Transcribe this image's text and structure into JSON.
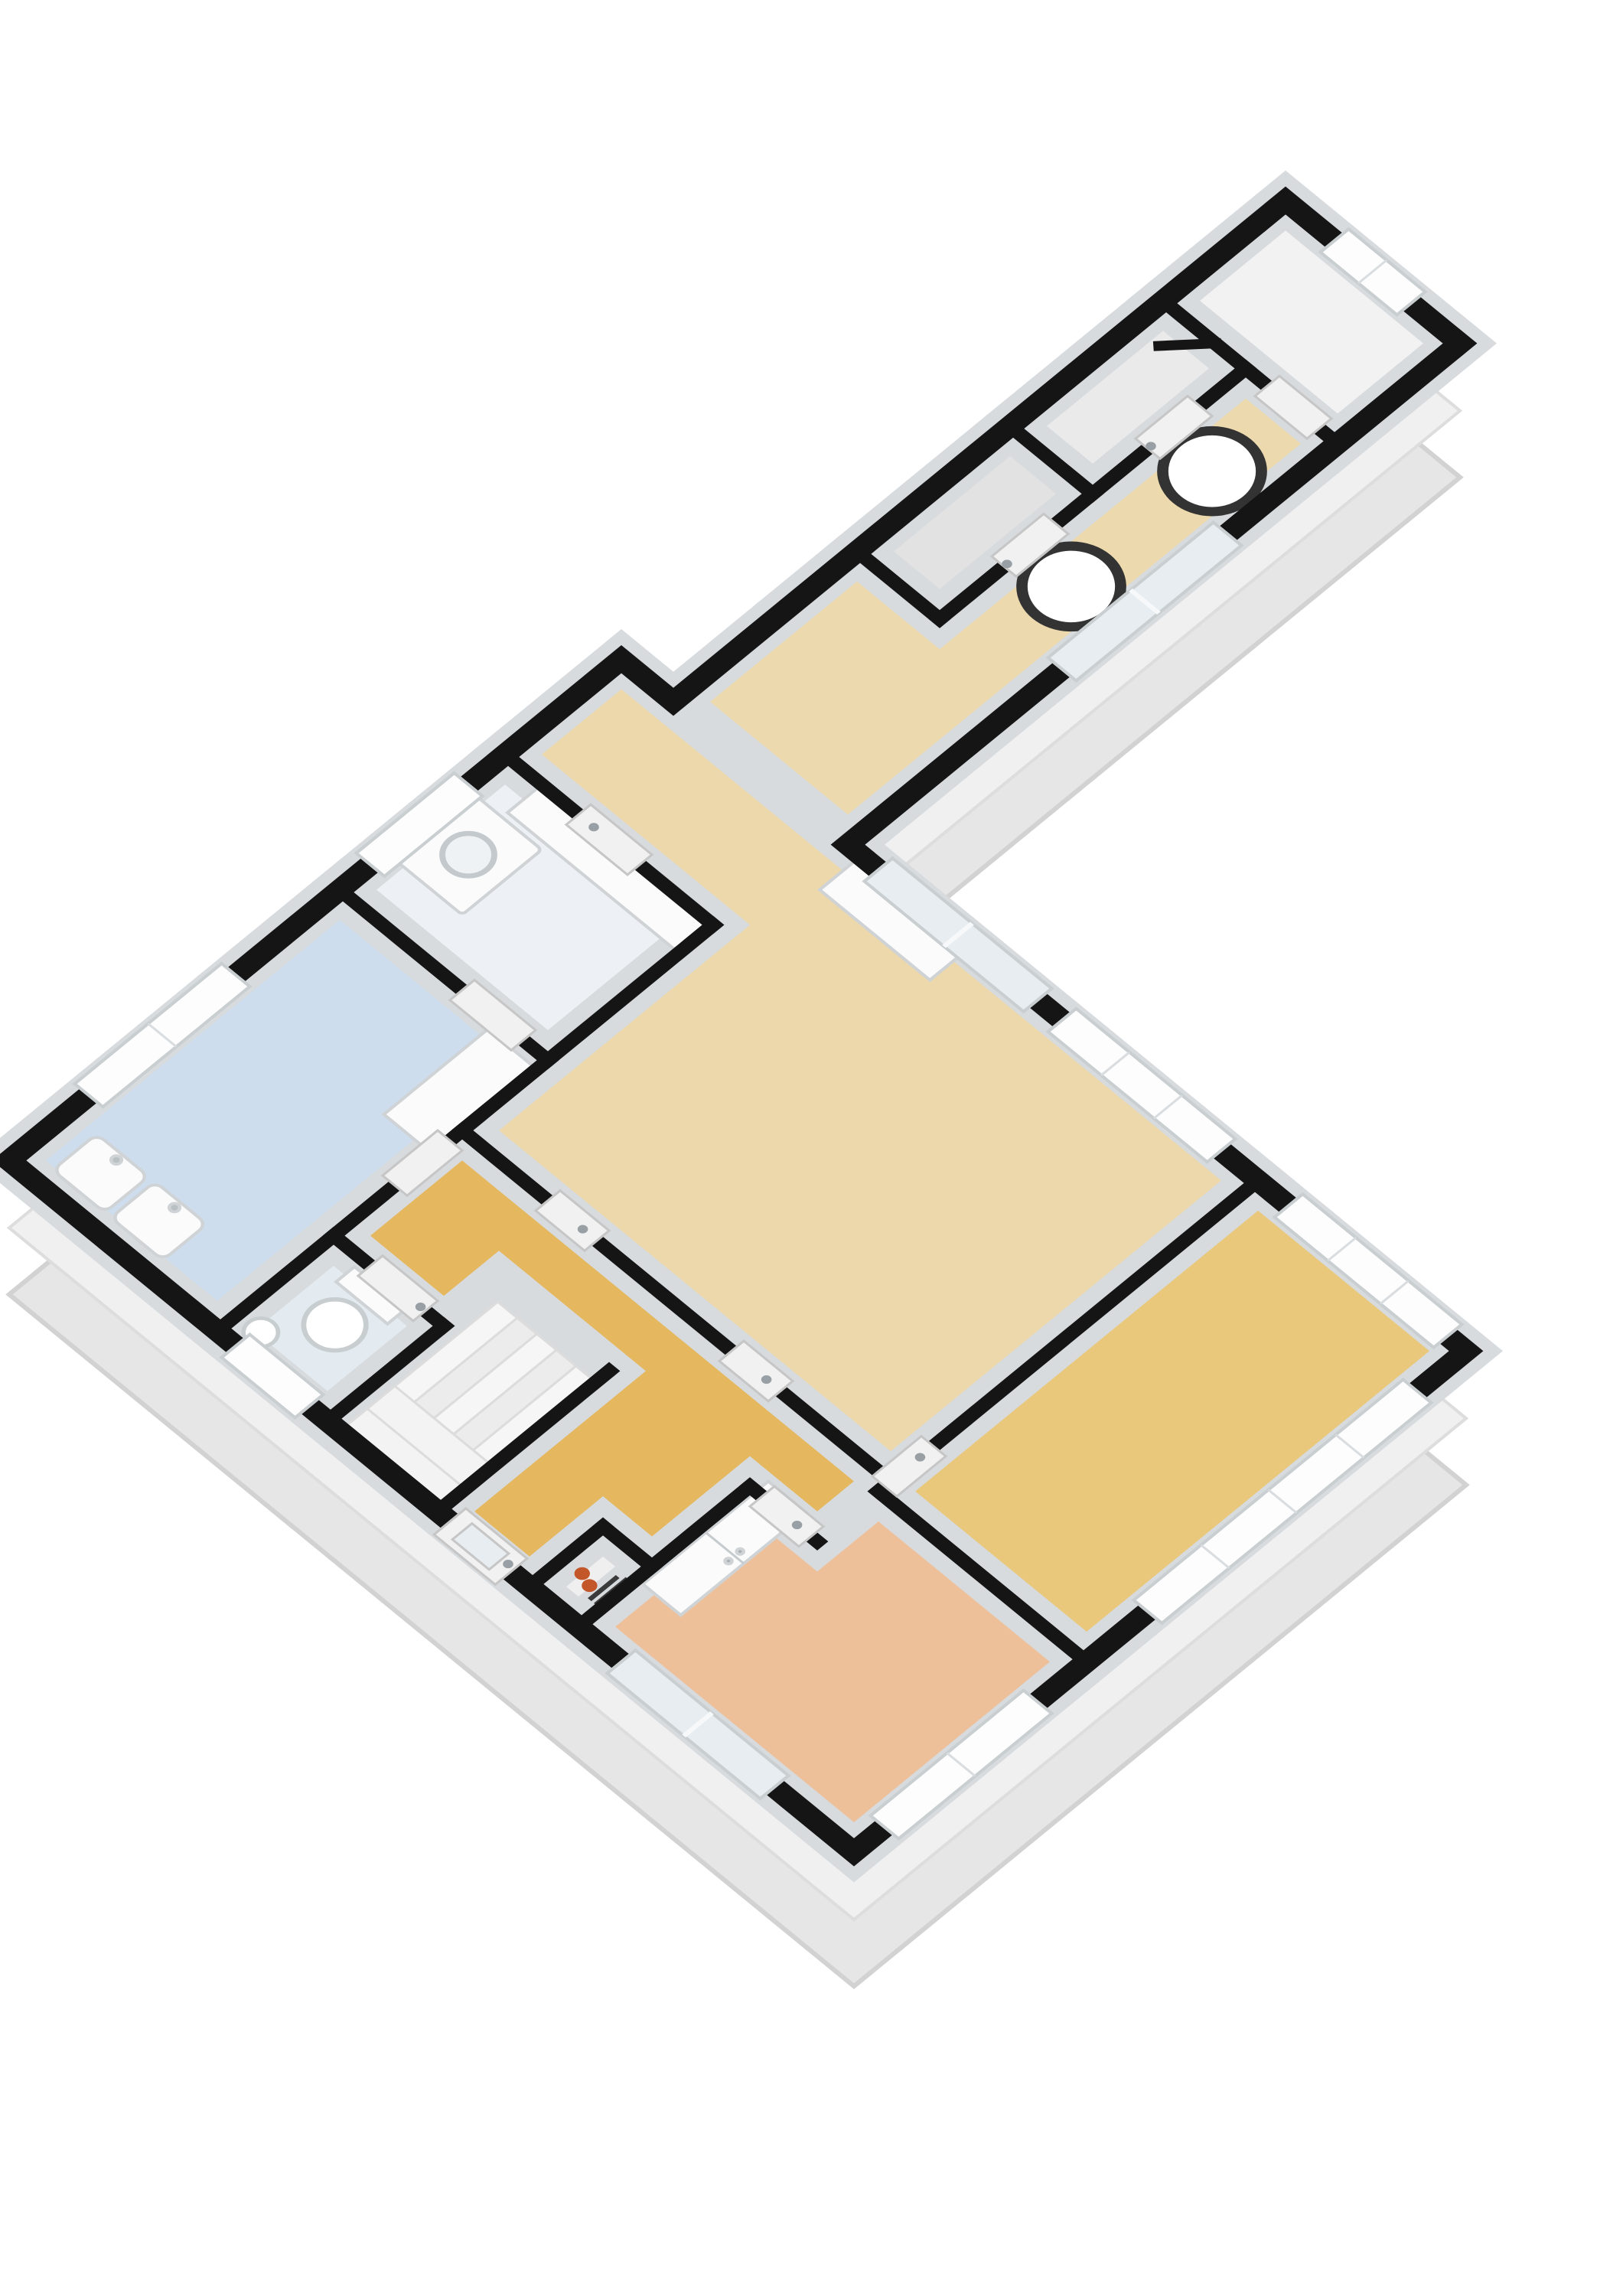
{
  "image_type": "3d-floor-plan-render",
  "view": "isometric-top-down",
  "background": "#ffffff",
  "palette": {
    "wall_cap": "#151515",
    "wall_inner": "#d7dbde",
    "extrude_far": "#e6e6e6",
    "extrude_near": "#f0f0f0",
    "window_glass": "#fdfdfd",
    "slider_glass": "#e7edf1",
    "window_frame": "#c9ced1",
    "mullion": "#d9dde0",
    "door_panel": "#f1f1f1",
    "door_frame": "#c6c6c6",
    "fixture_fill": "#fbfbfb",
    "fixture_stroke": "#cfd3d6",
    "handle_gray": "#98a0a5",
    "pipe_orange": "#c3572a",
    "rod_dark": "#3a3a3a",
    "ring_dark": "#333333",
    "stair_light": "#f6f6f6",
    "stair_mid": "#ececec",
    "stair_edge": "#dcdcdc"
  },
  "rooms": {
    "top_room": {
      "label": "top room",
      "color": "#f2f2f2"
    },
    "storage_1": {
      "label": "storage 1",
      "color": "#eaeaea"
    },
    "storage_2": {
      "label": "storage 2",
      "color": "#e2e2e2"
    },
    "wing_corridor": {
      "label": "corridor",
      "color": "#ecd9ae"
    },
    "living_room": {
      "label": "living room",
      "color": "#ecd8ab"
    },
    "utility_room": {
      "label": "utility room",
      "color": "#edf1f5"
    },
    "bathroom": {
      "label": "bathroom",
      "color": "#cedded"
    },
    "toilet_room": {
      "label": "toilet",
      "color": "#e3ebf1"
    },
    "stair_hall": {
      "label": "stair hall",
      "color": "#f1f3f4"
    },
    "hallway": {
      "label": "hallway",
      "color": "#e5b75e"
    },
    "bedroom_east": {
      "label": "bedroom east",
      "color": "#e9c87c"
    },
    "bedroom_south": {
      "label": "bedroom south",
      "color": "#eec09a"
    },
    "meter_niche": {
      "label": "meter cupboard",
      "color": "#efefef"
    }
  },
  "fixtures": [
    "washing-machine",
    "laundry-counter",
    "kitchen-counter",
    "bathroom-cabinet",
    "wash-basin-left",
    "wash-basin-right",
    "toilet",
    "hand-basin",
    "staircase",
    "wardrobe-closet",
    "heating-pipes",
    "round-table-upper",
    "round-table-lower"
  ],
  "counts": {
    "windows": 9,
    "sliding_glass_doors": 3,
    "interior_doors": 11,
    "entrance_doors": 1
  }
}
